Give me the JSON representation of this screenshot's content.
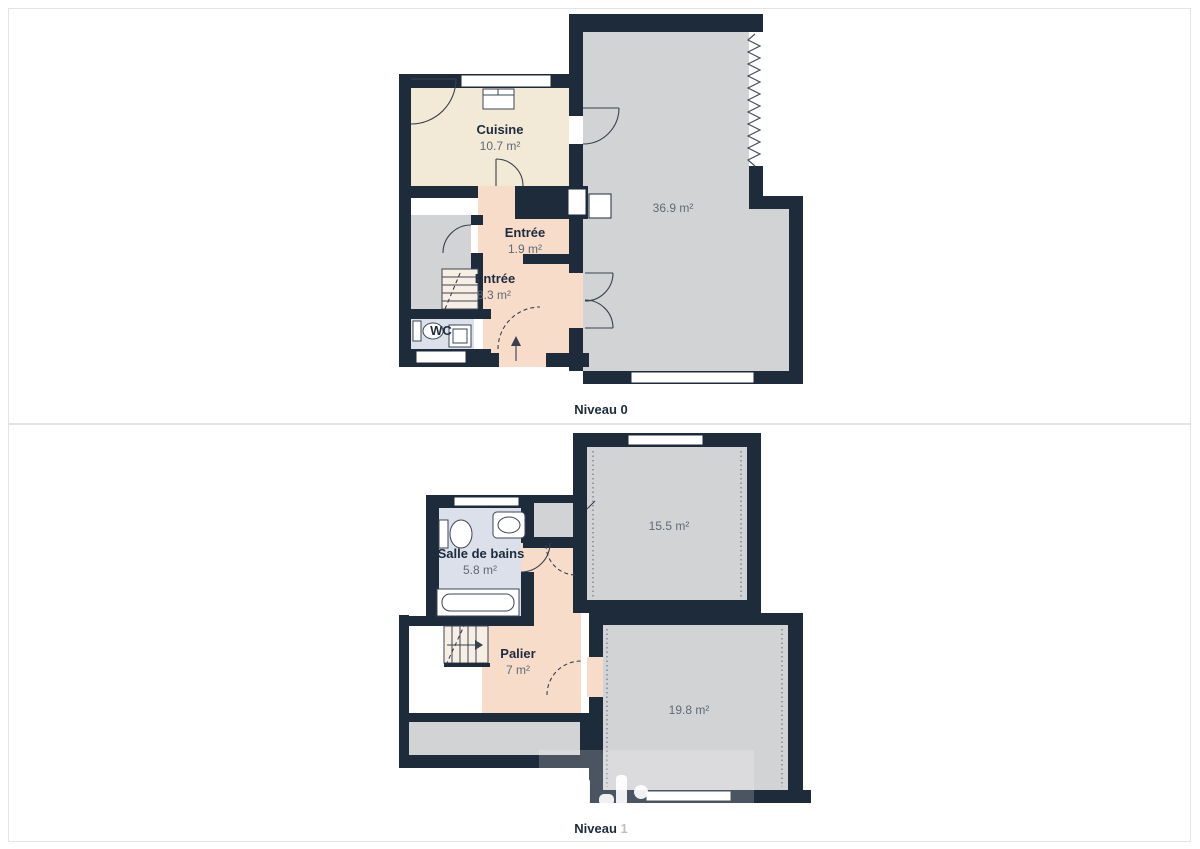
{
  "levels": [
    {
      "label": "Niveau 0",
      "rooms": {
        "cuisine": {
          "name": "Cuisine",
          "area": "10.7 m²"
        },
        "living": {
          "area": "36.9 m²"
        },
        "entree_small": {
          "name": "Entrée",
          "area": "1.9 m²"
        },
        "entree": {
          "name": "Entrée",
          "area": "8.3 m²"
        },
        "wc": {
          "name": "WC"
        }
      }
    },
    {
      "label": "Niveau 1",
      "rooms": {
        "bedroom_top": {
          "area": "15.5 m²"
        },
        "bathroom": {
          "name": "Salle de bains",
          "area": "5.8 m²"
        },
        "palier": {
          "name": "Palier",
          "area": "7 m²"
        },
        "bedroom_bottom": {
          "area": "19.8 m²"
        }
      }
    }
  ],
  "colors": {
    "wall": "#1e2b3b",
    "room_gray": "#d2d3d5",
    "room_beige": "#f2e9d7",
    "room_pink": "#f7dcca",
    "room_blue": "#dbe0ea",
    "label_text": "#1e2b3c",
    "area_text": "#5f6a76"
  }
}
